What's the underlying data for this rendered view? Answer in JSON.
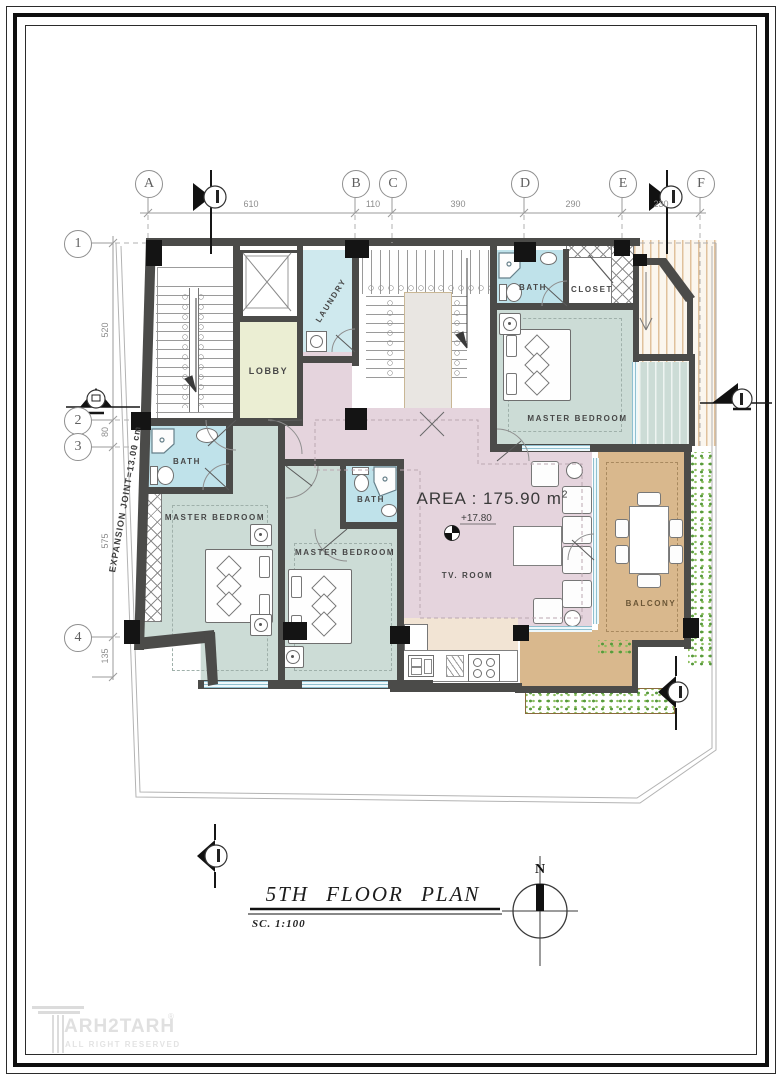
{
  "sheet": {
    "title": "5TH  FLOOR  PLAN",
    "scale": "SC.  1:100",
    "north": "N"
  },
  "brand": {
    "name": "ARH2TARH",
    "registered": "®",
    "tagline": "ALL RIGHT RESERVED"
  },
  "grid": {
    "cols": [
      {
        "label": "A"
      },
      {
        "label": "B"
      },
      {
        "label": "C"
      },
      {
        "label": "D"
      },
      {
        "label": "E"
      },
      {
        "label": "F"
      }
    ],
    "rows": [
      {
        "label": "1"
      },
      {
        "label": "2"
      },
      {
        "label": "3"
      },
      {
        "label": "4"
      }
    ],
    "top_dims": [
      "610",
      "110",
      "390",
      "290",
      "230"
    ],
    "left_dims": [
      "520",
      "80",
      "575",
      "135"
    ]
  },
  "annotations": {
    "area_label": "AREA : 175.90 m",
    "area_sup": "2",
    "level": "+17.80",
    "expansion_joint": "EXPANSION  JOINT=13.00  cm"
  },
  "rooms": [
    {
      "id": "lobby",
      "label": "LOBBY"
    },
    {
      "id": "laundry",
      "label": "LAUNDRY"
    },
    {
      "id": "bath-north",
      "label": "BATH"
    },
    {
      "id": "closet",
      "label": "CLOSET"
    },
    {
      "id": "master-bedroom-ne",
      "label": "MASTER  BEDROOM"
    },
    {
      "id": "bath-west",
      "label": "BATH"
    },
    {
      "id": "master-bedroom-sw",
      "label": "MASTER  BEDROOM"
    },
    {
      "id": "bath-mid",
      "label": "BATH"
    },
    {
      "id": "master-bedroom-s",
      "label": "MASTER  BEDROOM"
    },
    {
      "id": "tv-room",
      "label": "TV.  ROOM"
    },
    {
      "id": "balcony",
      "label": "BALCONY"
    }
  ],
  "colors": {
    "wall": "#4b4b49",
    "bath": "#bfe2ea",
    "bedroom": "#ccdcd6",
    "lobby": "#ebeed3",
    "tv_room": "#e5d4dd",
    "kitchen": "#f2e4d4",
    "balcony": "#d9b88d",
    "plants": "#579a3c"
  }
}
